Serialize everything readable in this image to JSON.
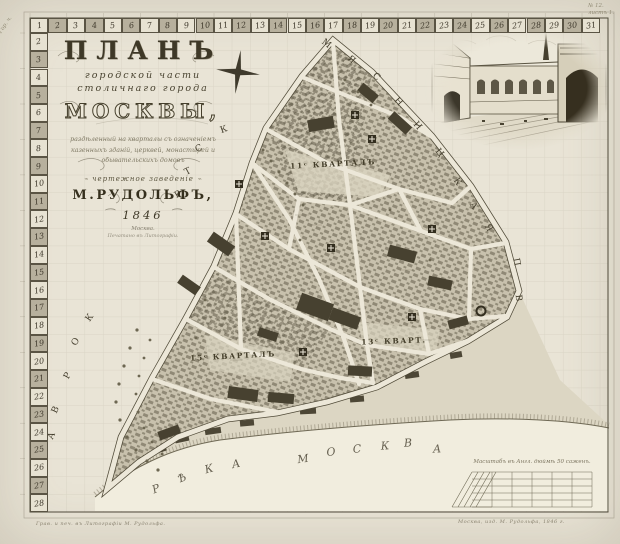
{
  "title_block": {
    "line1": "ПЛАНЪ",
    "line2": "городской части",
    "line3": "столичнаго города",
    "line4": "МОСКВЫ,",
    "script_lines": [
      "раздѣленный на кварталы съ означеніемъ",
      "казенныхъ зданій, церквей, монастырей и",
      "обывательскихъ домовъ"
    ],
    "cartouche": "чертежное заведеніе",
    "author": "М.РУДОЛЬФЪ,",
    "year": "1846",
    "place": "Москва.",
    "press_line": "Печатано въ Литографіи."
  },
  "border_scale": {
    "top_numbers": [
      "1",
      "2",
      "3",
      "4",
      "5",
      "6",
      "7",
      "8",
      "9",
      "10",
      "11",
      "12",
      "13",
      "14",
      "15",
      "16",
      "17",
      "18",
      "19",
      "20",
      "21",
      "22",
      "23",
      "24",
      "25",
      "26",
      "27",
      "28",
      "29",
      "30",
      "31"
    ],
    "left_numbers": [
      "2",
      "3",
      "4",
      "5",
      "6",
      "7",
      "8",
      "9",
      "10",
      "11",
      "12",
      "13",
      "14",
      "15",
      "16",
      "17",
      "18",
      "19",
      "20",
      "21",
      "22",
      "23",
      "24",
      "25",
      "26",
      "27",
      "28"
    ]
  },
  "map_labels": {
    "quarters": [
      {
        "text": "11ᶜ КВАРТАЛЪ",
        "x": 333,
        "y": 164,
        "r": -3
      },
      {
        "text": "13ᶜ КВАРТ.",
        "x": 394,
        "y": 341,
        "r": -2
      },
      {
        "text": "15ᶜ КВАРТАЛЪ",
        "x": 233,
        "y": 356,
        "r": -3
      }
    ],
    "street_letters": [
      {
        "ch": "М",
        "x": 326,
        "y": 44,
        "r": 38
      },
      {
        "ch": "Я",
        "x": 351,
        "y": 60,
        "r": 42
      },
      {
        "ch": "С",
        "x": 376,
        "y": 77,
        "r": 45
      },
      {
        "ch": "Н",
        "x": 398,
        "y": 102,
        "r": 48
      },
      {
        "ch": "И",
        "x": 417,
        "y": 126,
        "r": 50
      },
      {
        "ch": "Ц",
        "x": 439,
        "y": 153,
        "r": 52
      },
      {
        "ch": "К",
        "x": 457,
        "y": 182,
        "r": 56
      },
      {
        "ch": "А",
        "x": 473,
        "y": 206,
        "r": 58
      },
      {
        "ch": "Я",
        "x": 488,
        "y": 228,
        "r": 60
      },
      {
        "ch": "П",
        "x": 516,
        "y": 262,
        "r": 80
      },
      {
        "ch": "В",
        "x": 518,
        "y": 298,
        "r": 84
      },
      {
        "ch": "С",
        "x": 199,
        "y": 149,
        "r": -25
      },
      {
        "ch": "Т",
        "x": 188,
        "y": 172,
        "r": -28
      },
      {
        "ch": "Р",
        "x": 178,
        "y": 195,
        "r": -30
      },
      {
        "ch": "К",
        "x": 224,
        "y": 130,
        "r": -20
      },
      {
        "ch": "К",
        "x": 90,
        "y": 318,
        "r": -55
      },
      {
        "ch": "О",
        "x": 76,
        "y": 342,
        "r": -58
      },
      {
        "ch": "Р",
        "x": 68,
        "y": 376,
        "r": -62
      },
      {
        "ch": "В",
        "x": 56,
        "y": 410,
        "r": -65
      },
      {
        "ch": "А",
        "x": 52,
        "y": 436,
        "r": -68
      }
    ],
    "river_name_letters": [
      {
        "ch": "Р",
        "x": 156,
        "y": 489,
        "r": -22
      },
      {
        "ch": "Ѣ",
        "x": 182,
        "y": 478,
        "r": -20
      },
      {
        "ch": "К",
        "x": 209,
        "y": 469,
        "r": -16
      },
      {
        "ch": "А",
        "x": 236,
        "y": 464,
        "r": -12
      },
      {
        "ch": "М",
        "x": 303,
        "y": 459,
        "r": -8
      },
      {
        "ch": "О",
        "x": 331,
        "y": 452,
        "r": -6
      },
      {
        "ch": "С",
        "x": 357,
        "y": 449,
        "r": -5
      },
      {
        "ch": "К",
        "x": 385,
        "y": 446,
        "r": -4
      },
      {
        "ch": "В",
        "x": 408,
        "y": 443,
        "r": -3
      },
      {
        "ch": "А",
        "x": 437,
        "y": 449,
        "r": -2
      }
    ]
  },
  "scale_bar": {
    "caption": "Масштабъ въ Англ. дюймѣ 50 саженъ."
  },
  "imprints": {
    "left": "Грав. и печ. въ Литографіи М. Рудольфа.",
    "right": "Москва, изд. М. Рудольфа, 1846 г."
  },
  "corner_notes": {
    "left": "Гор. ч.",
    "right_1": "№ 12.",
    "right_2": "листъ 1."
  }
}
